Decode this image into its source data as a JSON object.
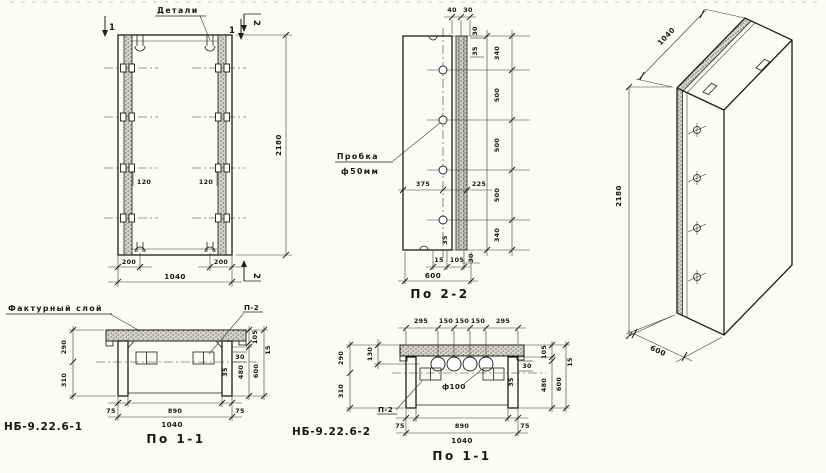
{
  "labels": {
    "details": "Детали",
    "facture": "Фактурный слой",
    "plug": "Пробка",
    "plug_dia": "ф50мм",
    "p2": "П-2",
    "hole_dia": "ф100",
    "mark1": "НБ-9.22.6-1",
    "mark2": "НБ-9.22.6-2",
    "sec11": "По 1-1",
    "sec22": "По 2-2",
    "cut1": "1",
    "cut2": "2"
  },
  "front": {
    "d120": "120",
    "d200": "200",
    "d1040": "1040",
    "d2180": "2180"
  },
  "side": {
    "top": [
      "40",
      "30"
    ],
    "right_top": [
      "30",
      "35"
    ],
    "right": [
      "340",
      "500",
      "500",
      "500",
      "340"
    ],
    "right_bottom": [
      "35",
      "30"
    ],
    "mid": [
      "375",
      "225"
    ],
    "bottom": [
      "15",
      "105",
      "600"
    ]
  },
  "iso": {
    "d1040": "1040",
    "d2180": "2180",
    "d600": "600"
  },
  "s1": {
    "left": [
      "290",
      "310"
    ],
    "right": [
      "105",
      "15",
      "480",
      "600"
    ],
    "wall": [
      "30",
      "35"
    ],
    "bottom": [
      "75",
      "890",
      "75",
      "1040"
    ]
  },
  "s2": {
    "top": [
      "295",
      "150",
      "150",
      "150",
      "295"
    ],
    "d130": "130",
    "left": [
      "290",
      "310"
    ],
    "right": [
      "105",
      "15",
      "480",
      "600"
    ],
    "wall": [
      "30",
      "35"
    ],
    "bottom": [
      "75",
      "890",
      "75",
      "1040"
    ]
  }
}
